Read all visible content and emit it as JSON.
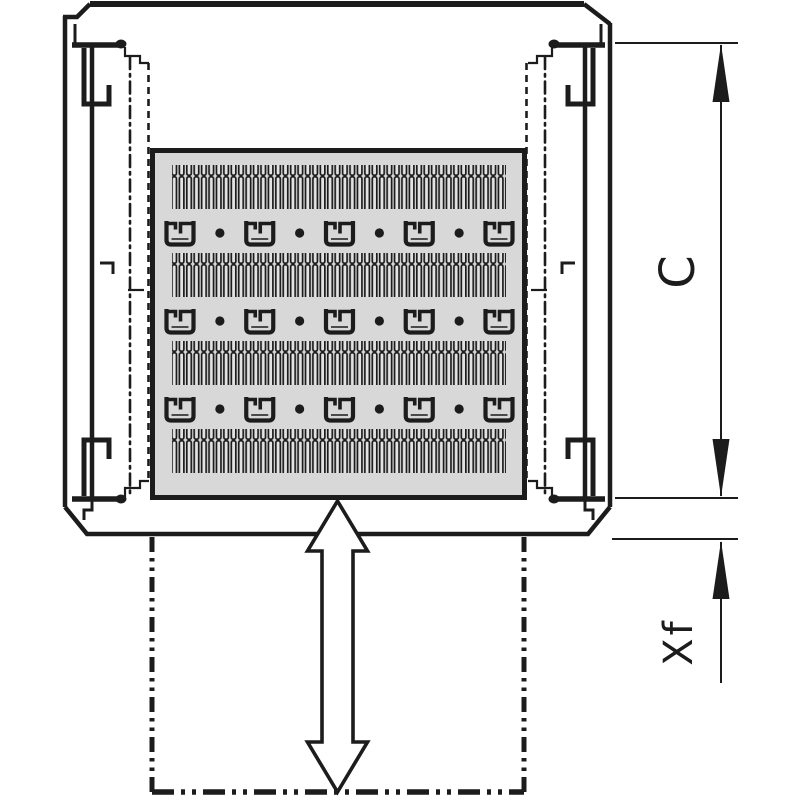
{
  "drawing": {
    "dimension_labels": {
      "c": "C",
      "xf": "Xf"
    },
    "colors": {
      "line": "#1c1c1c",
      "panel": "#d8d8d8",
      "slot": "#e3e3e3",
      "background": "#ffffff"
    },
    "shelf_pattern": {
      "slot_rows": 4,
      "clip_rows": 3,
      "clips_per_row": 5,
      "dots_per_row": 4,
      "slots_per_row": 45
    }
  }
}
